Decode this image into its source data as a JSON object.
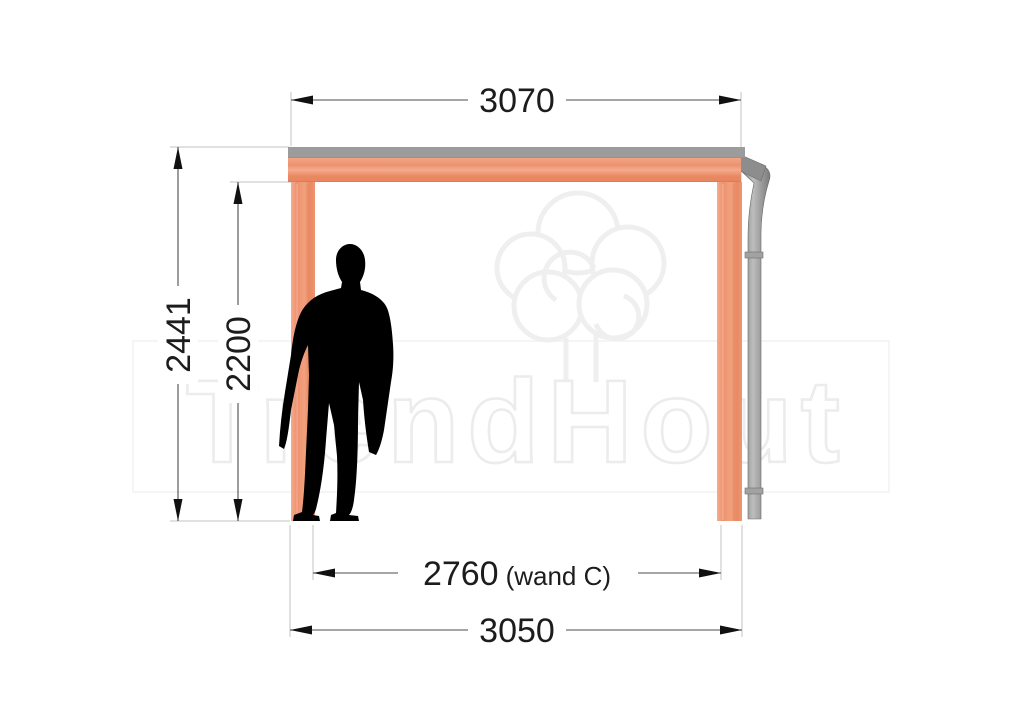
{
  "drawing": {
    "type": "technical-elevation-drawing",
    "subject": "timber veranda side elevation with dimensions",
    "watermark": {
      "brand": "TrendHout",
      "logo_icon": "tree-logo",
      "outline_color": "#ececec"
    },
    "dims": {
      "roof_width": {
        "value": "3070"
      },
      "total_height": {
        "value": "2441"
      },
      "passage_height": {
        "value": "2200"
      },
      "wall_span": {
        "value": "2760",
        "suffix": "(wand C)"
      },
      "post_span": {
        "value": "3050"
      }
    },
    "colors": {
      "wood": "#ee9572",
      "wood_light": "#f5ab8c",
      "wood_dark": "#e2835d",
      "roof_edge_gray": "#9c9c9c",
      "drainpipe_gray": "#8f8f8f",
      "dimension_line": "#4d4d4d",
      "extension_line": "#c3c3c3",
      "dimension_text": "#1c1c1c",
      "person_silhouette": "#000000"
    },
    "figures": {
      "person": "human-scale-silhouette"
    }
  }
}
